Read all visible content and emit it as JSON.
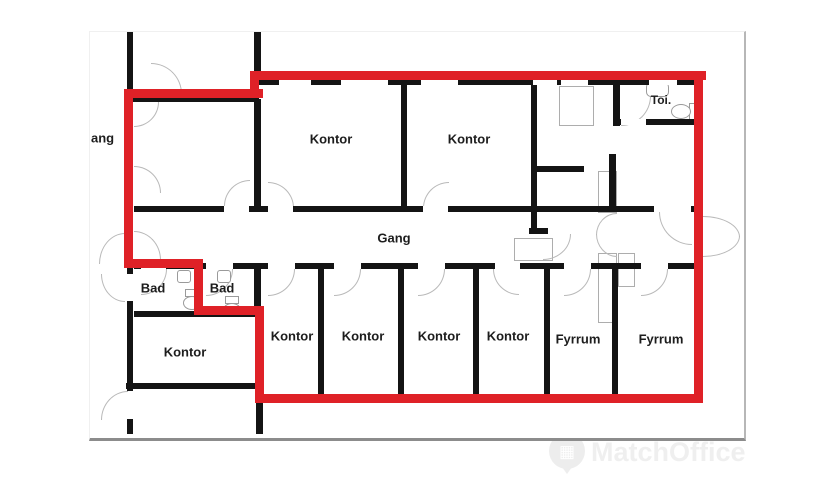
{
  "document": {
    "type": "floor-plan",
    "language": "Danish"
  },
  "rooms": {
    "gang_partial": "ang",
    "kontor_top_1": "Kontor",
    "kontor_top_2": "Kontor",
    "toi": "Toi.",
    "gang": "Gang",
    "bad_1": "Bad",
    "bad_2": "Bad",
    "kontor_left": "Kontor",
    "kontor_bottom_1": "Kontor",
    "kontor_bottom_2": "Kontor",
    "kontor_bottom_3": "Kontor",
    "kontor_bottom_4": "Kontor",
    "fyrrum_1": "Fyrrum",
    "fyrrum_2": "Fyrrum"
  },
  "highlight": {
    "meaning": "selected-lease-area-outline",
    "color": "#df2127"
  },
  "colors": {
    "wall": "#141414",
    "door_arc": "#b9b9b9",
    "canvas_edge_bottom": "#8c8c8c",
    "canvas_edge_right": "#b7b7b7"
  },
  "watermark": {
    "brand": "MatchOffice",
    "icon": "map-pin-with-building",
    "color": "#efefef"
  }
}
